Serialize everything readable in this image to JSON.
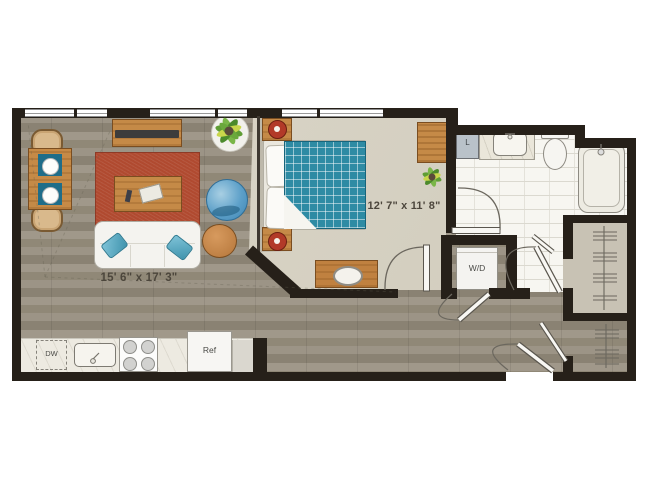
{
  "rooms": {
    "living_room": {
      "dimensions": "15' 6\" x 17' 3\""
    },
    "bedroom": {
      "dimensions": "12' 7\" x 11' 8\""
    }
  },
  "labels": {
    "washer_dryer": "W/D",
    "refrigerator": "Ref",
    "dishwasher": "DW",
    "linen_closet": "L"
  },
  "colors": {
    "wall": "#262019",
    "wood_floor": "#998f7f",
    "bedroom_carpet": "#d8d3c5",
    "bath_tile": "#f7f6f1",
    "closet_floor": "#c8c2b4",
    "rug_red": "#b04a30",
    "quilt_teal": "#2e8ba4",
    "accent_wood": "#c58a47",
    "pillow_teal": "#4f9cb5",
    "lamp_red": "#b23a28"
  }
}
